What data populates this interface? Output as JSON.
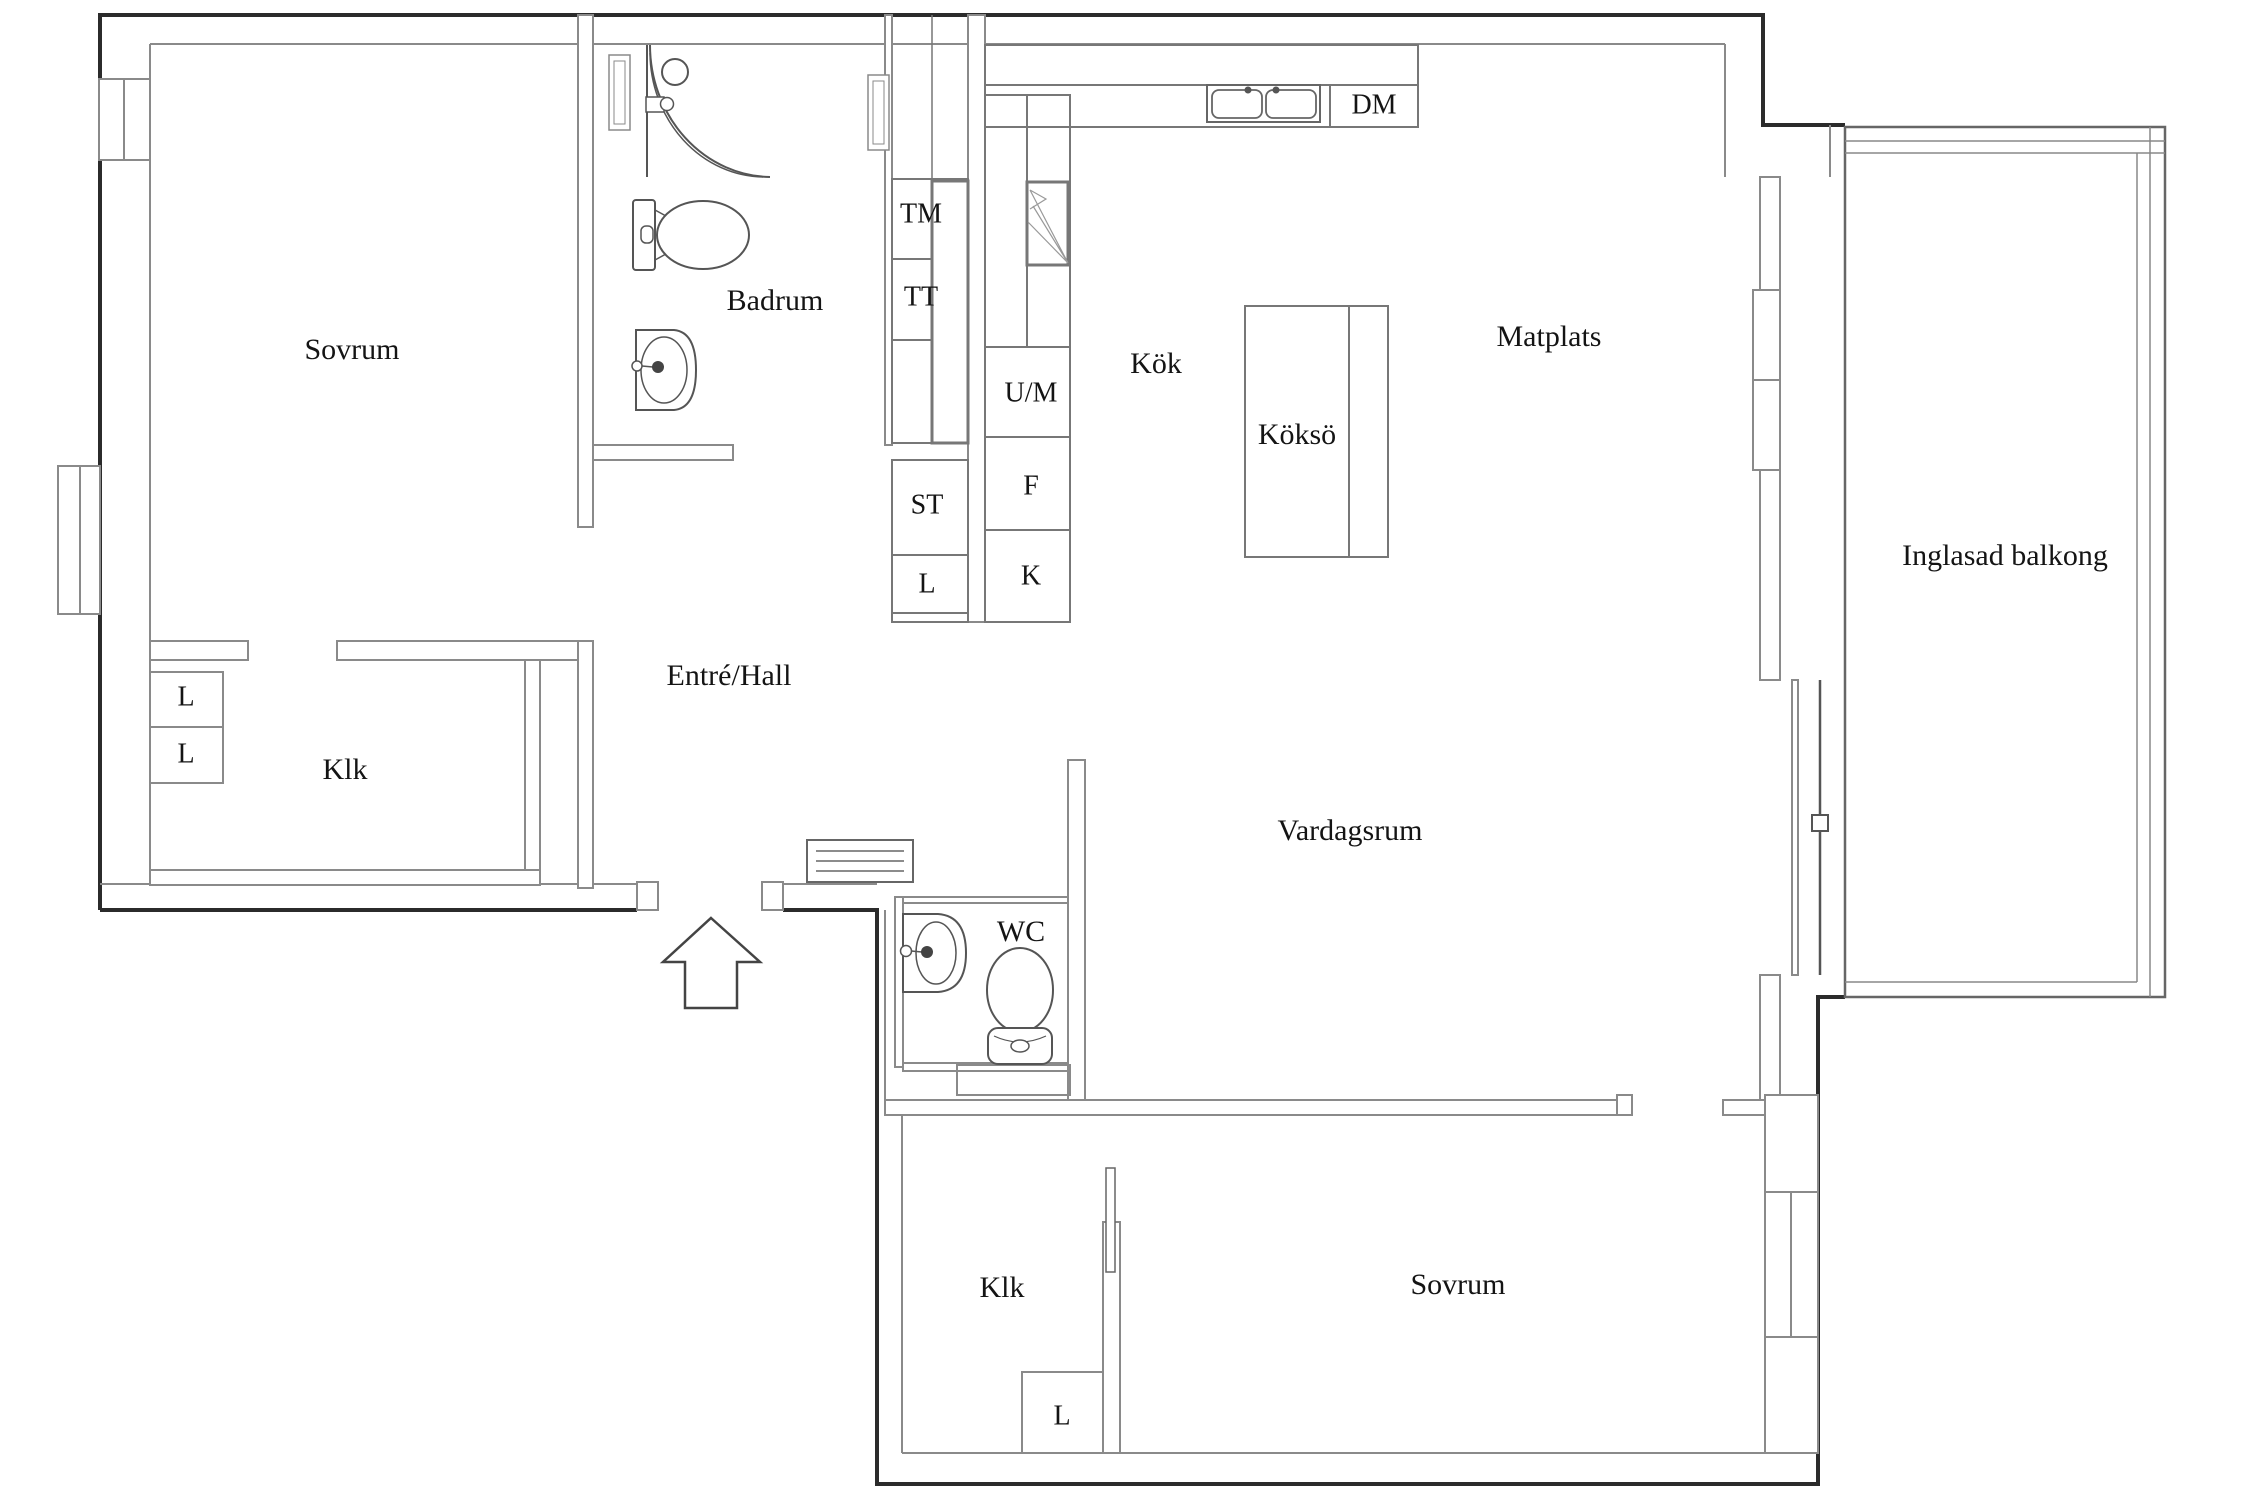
{
  "plan": {
    "type": "apartment-floor-plan",
    "language": "Swedish"
  },
  "rooms": {
    "sovrum_top": "Sovrum",
    "badrum": "Badrum",
    "kok": "Kök",
    "matplats": "Matplats",
    "kokso": "Köksö",
    "inglasad_balkong": "Inglasad balkong",
    "entre_hall": "Entré/Hall",
    "klk_left": "Klk",
    "vardagsrum": "Vardagsrum",
    "wc": "WC",
    "klk_bottom": "Klk",
    "sovrum_bottom": "Sovrum"
  },
  "appliances": {
    "tm": "TM",
    "tt": "TT",
    "st": "ST",
    "l_hall": "L",
    "um": "U/M",
    "f": "F",
    "k": "K",
    "dm": "DM",
    "l_klk_1": "L",
    "l_klk_2": "L",
    "l_klk_bottom": "L"
  },
  "icons": [
    "shower-icon",
    "toilet-icon",
    "washbasin-icon",
    "kitchen-sink-icon",
    "corner-cabinet-icon",
    "entrance-arrow-icon",
    "doormat-icon",
    "sliding-door-icon",
    "window-icon",
    "balcony-door-icon",
    "duct-shaft-icon"
  ],
  "colors": {
    "background": "#ffffff",
    "exterior_wall": "#2b2b2b",
    "interior_wall": "#8a8a8a",
    "fixture": "#555555",
    "text": "#141414"
  }
}
